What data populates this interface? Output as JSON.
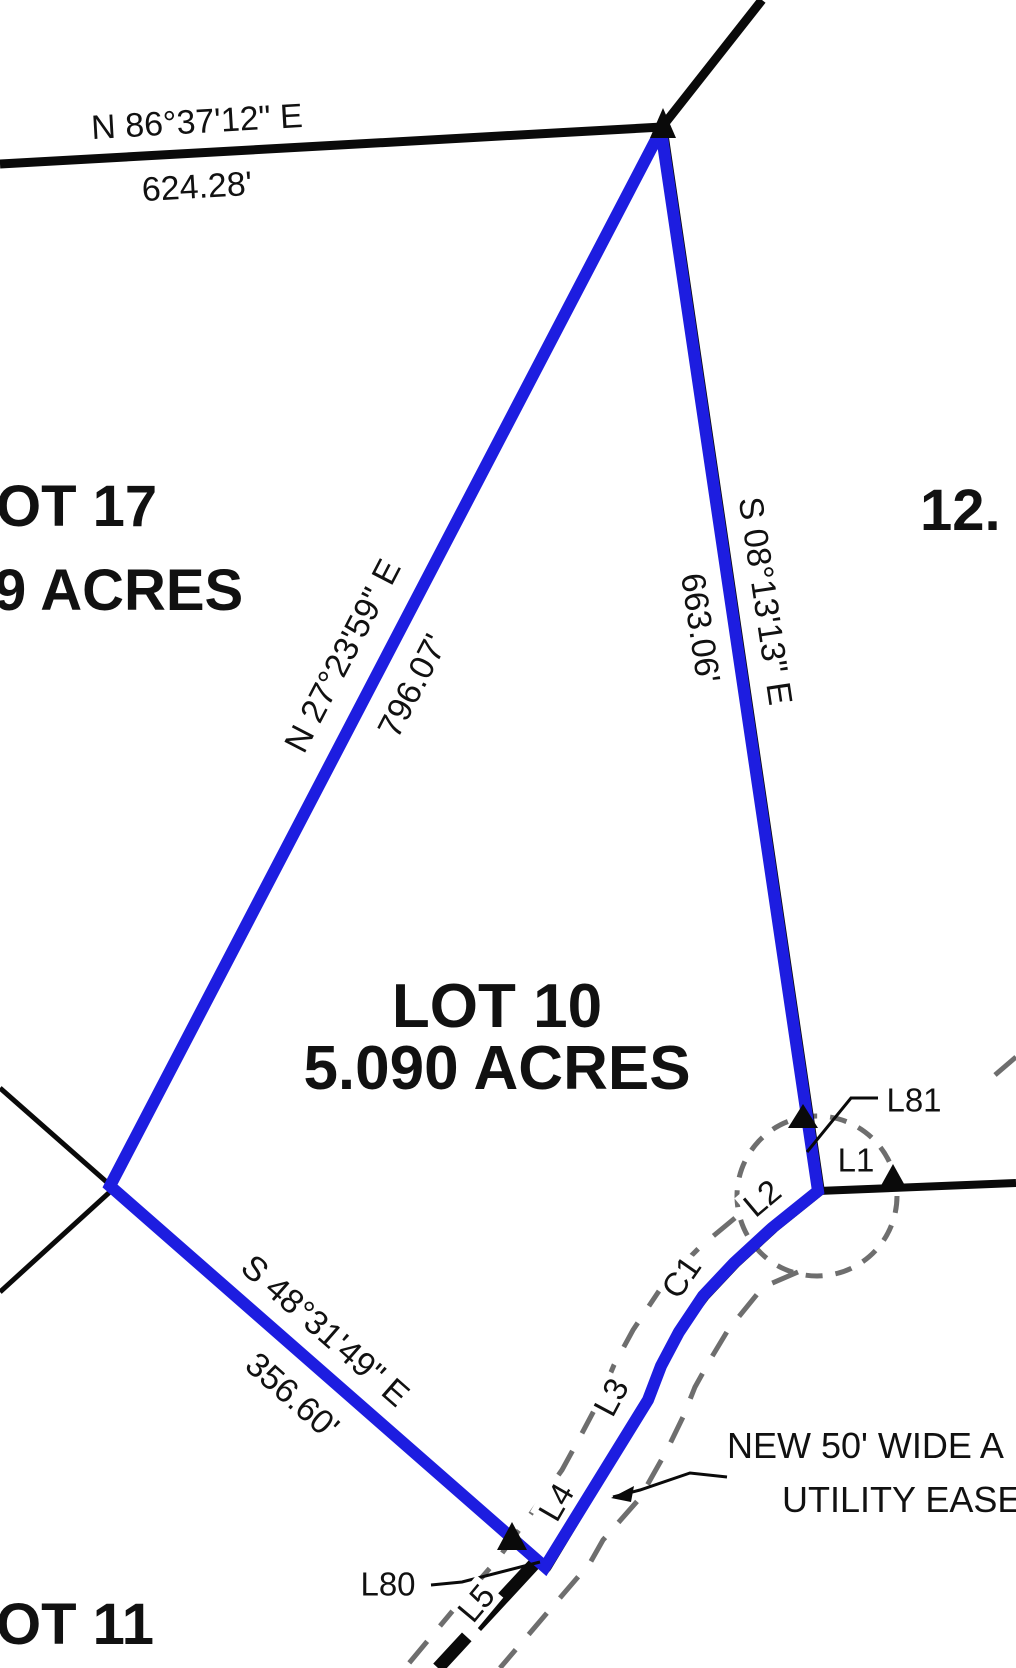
{
  "colors": {
    "boundary_blue": "#1d1de0",
    "line_black": "#0a0a0a",
    "easement_gray": "#6e6e6e",
    "text": "#111111"
  },
  "lots": {
    "lot10": {
      "name": "LOT 10",
      "area": "5.090 ACRES"
    },
    "lot17_partial": {
      "name": "OT 17",
      "area": "9 ACRES"
    },
    "lot11_partial": {
      "name": "OT 11"
    },
    "lot12_partial": {
      "name": "12."
    }
  },
  "bearings": [
    {
      "id": "north-line",
      "bearing": "N 86°37'12\" E",
      "distance": "624.28'"
    },
    {
      "id": "northwest-line",
      "bearing": "N 27°23'59\" E",
      "distance": "796.07'"
    },
    {
      "id": "east-line",
      "bearing": "S 08°13'13\" E",
      "distance": "663.06'"
    },
    {
      "id": "southwest-line",
      "bearing": "S 48°31'49\" E",
      "distance": "356.60'"
    }
  ],
  "segment_labels": {
    "l81": "L81",
    "l1": "L1",
    "l2": "L2",
    "c1": "C1",
    "l3": "L3",
    "l4": "L4",
    "l5": "L5",
    "l80": "L80"
  },
  "easement_note": {
    "line1": "NEW 50' WIDE A",
    "line2": "UTILITY EASE"
  }
}
